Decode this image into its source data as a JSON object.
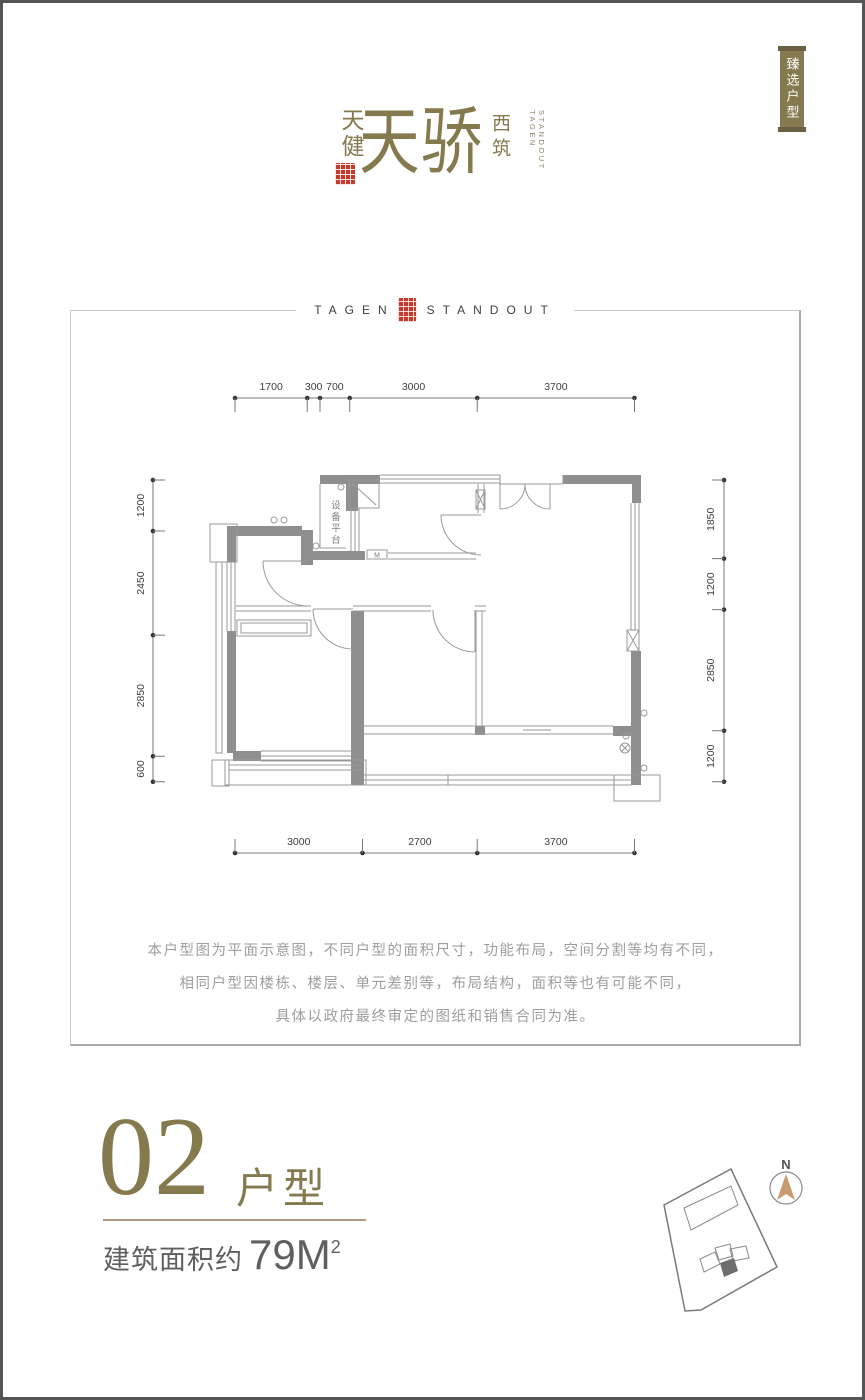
{
  "brand": {
    "side_name": "天健",
    "main_name": "天骄",
    "suffix_name": "西筑",
    "en_col1": "TAGEN",
    "en_col2": "STANDOUT"
  },
  "corner_banner": {
    "text": "臻选户型"
  },
  "plan_box": {
    "title_en_left": "TAGEN",
    "title_en_right": "STANDOUT"
  },
  "floorplan": {
    "equipment_platform_label": "设备平台",
    "door_marker": "M",
    "dimensions_mm": {
      "top": [
        1700,
        300,
        700,
        3000,
        3700
      ],
      "bottom": [
        3000,
        2700,
        3700
      ],
      "left": [
        1200,
        2450,
        2850,
        600
      ],
      "right": [
        1850,
        1200,
        2850,
        1200
      ]
    }
  },
  "disclaimer": {
    "line1": "本户型图为平面示意图，不同户型的面积尺寸，功能布局，空间分割等均有不同，",
    "line2": "相同户型因楼栋、楼层、单元差别等，布局结构，面积等也有可能不同，",
    "line3": "具体以政府最终审定的图纸和销售合同为准。"
  },
  "unit_info": {
    "number": "02",
    "type_label": "户型",
    "area_label": "建筑面积约",
    "area_value": "79M",
    "area_superscript": "2"
  },
  "compass": {
    "north_label": "N"
  },
  "colors": {
    "brand_olive": "#85794E",
    "seal_red": "#C8392B",
    "wall_gray": "#8F8F8F",
    "north_arrow_tan": "#C89B6E"
  }
}
